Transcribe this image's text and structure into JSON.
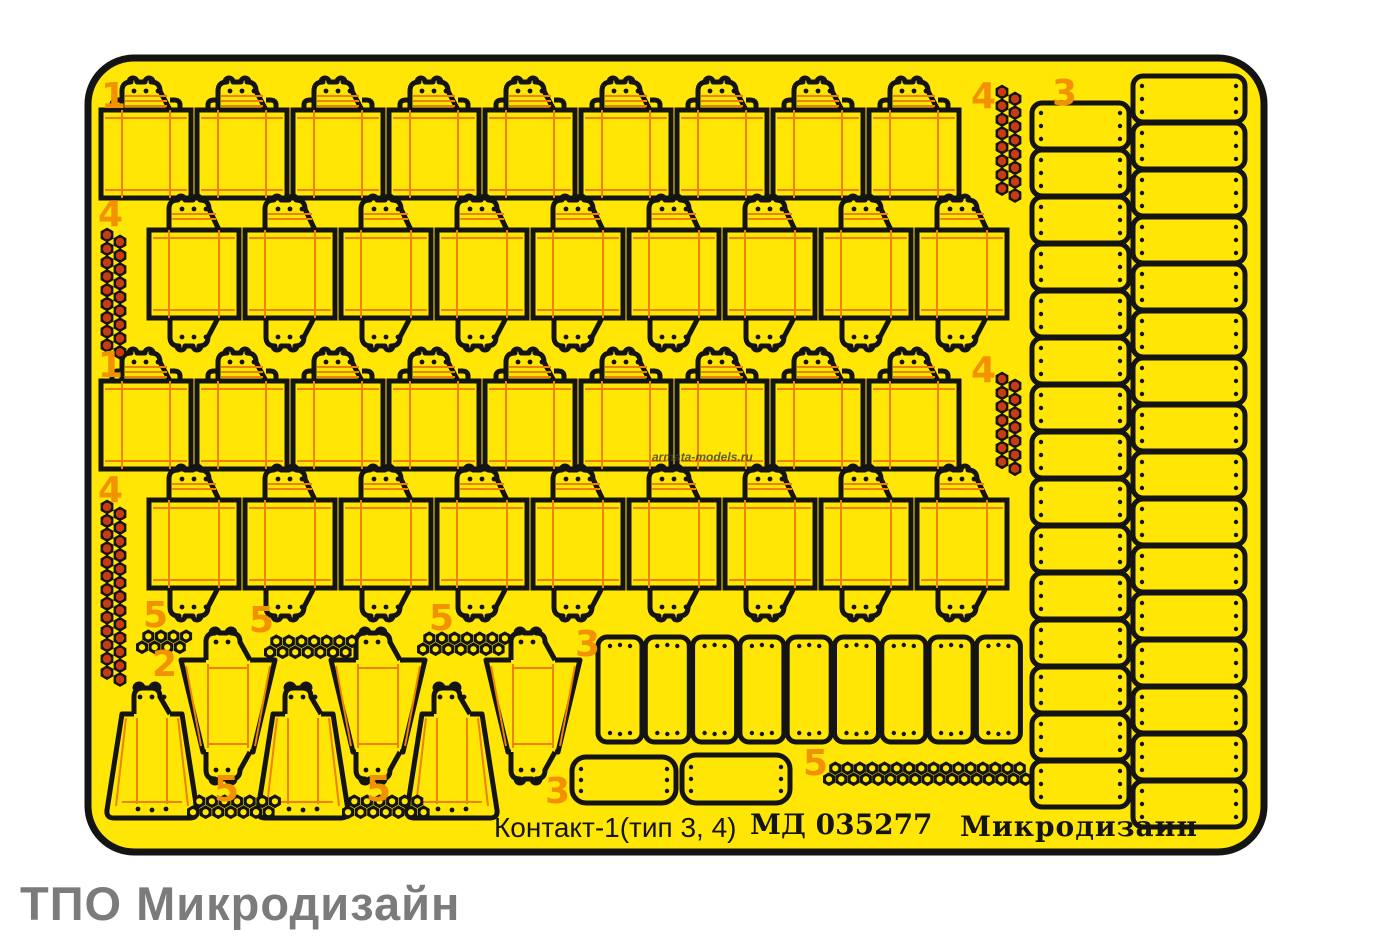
{
  "sheet": {
    "title": "Контакт-1(тип 3, 4)",
    "code": "МД 035277",
    "brand": "Микродизаин",
    "producer": "ТПО Микродизайн",
    "watermark": "armata-models.ru"
  },
  "colors": {
    "background": "#ffffff",
    "fret_yellow": "#FFE604",
    "outline_black": "#141414",
    "accent_orange": "#F29200",
    "fold_line_orange": "#EF8300",
    "rivet_red": "#C93B12",
    "producer_gray": "#7B7B7B",
    "watermark_gray": "#3C3C3C"
  },
  "part_labels": [
    "1",
    "4",
    "3",
    "4",
    "1",
    "4",
    "4",
    "5",
    "5",
    "5",
    "2",
    "3",
    "5",
    "3",
    "5",
    "5"
  ],
  "part_counts": {
    "era_block_rows": 4,
    "era_blocks_per_row": 9,
    "side_plate_columns": 2,
    "side_plates_inner_column": 15,
    "side_plates_outer_column": 16,
    "middle_plates": 9,
    "small_end_plates": 2,
    "trapezoid_parts": 6,
    "red_rivet_strips": 4,
    "hex_nut_clusters": 5,
    "hex_nut_strips": 1
  }
}
